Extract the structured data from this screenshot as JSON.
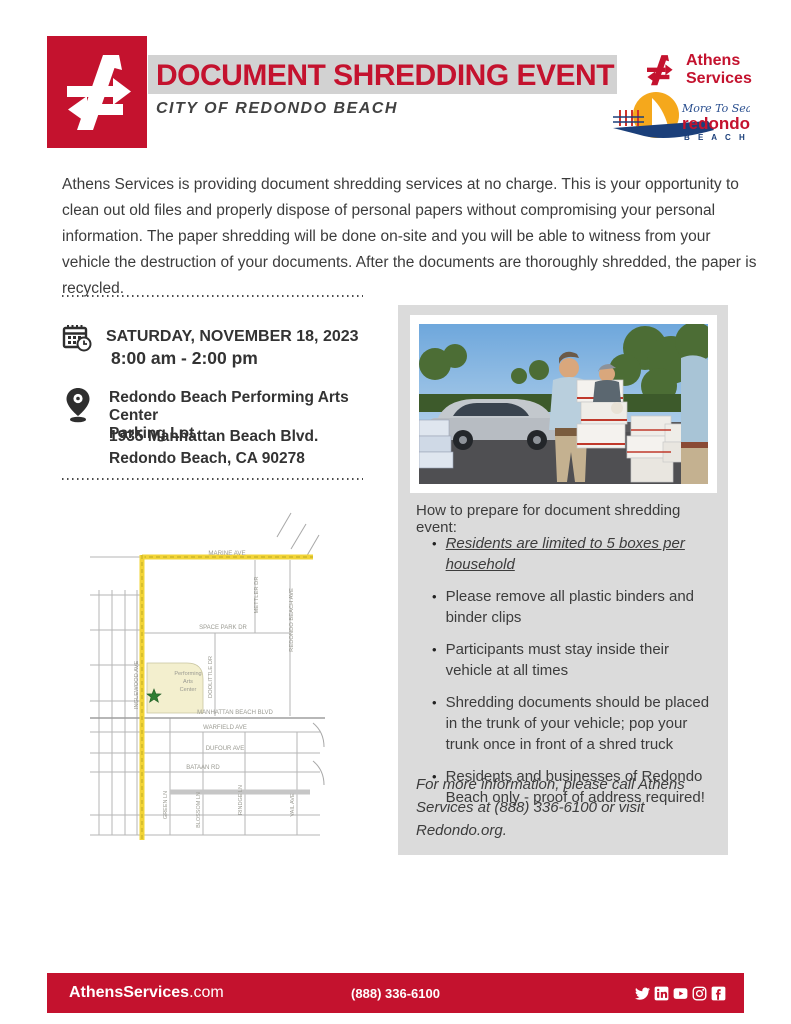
{
  "colors": {
    "athens_red": "#C4122E",
    "title_bar_gray": "#D2D2D2",
    "panel_gray": "#DBDBDB",
    "body_text": "#3C3C3C",
    "map_highlight_yellow": "#F2D437",
    "redondo_blue": "#1B3F7A",
    "redondo_sun": "#F5A81C"
  },
  "header": {
    "title": "DOCUMENT SHREDDING EVENT",
    "subtitle": "CITY OF REDONDO BEACH",
    "athens_line1": "Athens",
    "athens_line2": "Services",
    "redondo": {
      "tagline": "More To Sea",
      "name": "redondo",
      "beach": "B E A C H"
    }
  },
  "intro": "Athens Services is providing document shredding services at no charge. This is your opportunity to clean out old files and properly dispose of personal papers without compromising your personal information. The paper shredding will be done on-site and you will be able to witness from your vehicle the destruction of your documents. After the documents are thoroughly shredded, the paper is recycled.",
  "event": {
    "date": "SATURDAY, NOVEMBER 18, 2023",
    "time": "8:00 am - 2:00 pm",
    "venue1": "Redondo Beach Performing Arts Center",
    "venue2": "Parking Lot",
    "address1": "1935 Manhattan Beach Blvd.",
    "address2": "Redondo Beach, CA 90278"
  },
  "map": {
    "streets": {
      "marine": "MARINE AVE",
      "inglewood": "INGLEWOOD AVE",
      "mettler": "METTLER DR",
      "redondo_beach": "REDONDO BEACH AVE",
      "space_park": "SPACE PARK DR",
      "doolittle": "DOOLITTLE DR",
      "manhattan_beach": "MANHATTAN BEACH BLVD",
      "warfield": "WARFIELD AVE",
      "dufour": "DUFOUR AVE",
      "bataan": "BATAAN RD",
      "green": "GREEN LN",
      "blossom": "BLOSSOM LN",
      "rindge": "RINDGE LN",
      "vail": "VAIL AVE"
    },
    "poi1": "Performing",
    "poi2": "Arts",
    "poi3": "Center"
  },
  "prepare": {
    "heading": "How to prepare for document shredding event:",
    "bullet_char": "•",
    "bullets": [
      "Residents are limited to 5 boxes per household",
      "Please remove all plastic binders and binder clips",
      "Participants must stay inside their vehicle at all times",
      "Shredding documents should be placed in the trunk of your vehicle; pop your trunk once in front of a shred truck",
      "Residents and businesses of Redondo Beach only - proof of address required!"
    ],
    "note": "For more information, please call Athens Services at (888) 336-6100 or visit Redondo.org."
  },
  "footer": {
    "site_bold": "AthensServices",
    "site_rest": ".com",
    "phone": "(888) 336-6100",
    "social": [
      "twitter",
      "linkedin",
      "youtube",
      "instagram",
      "facebook"
    ]
  }
}
